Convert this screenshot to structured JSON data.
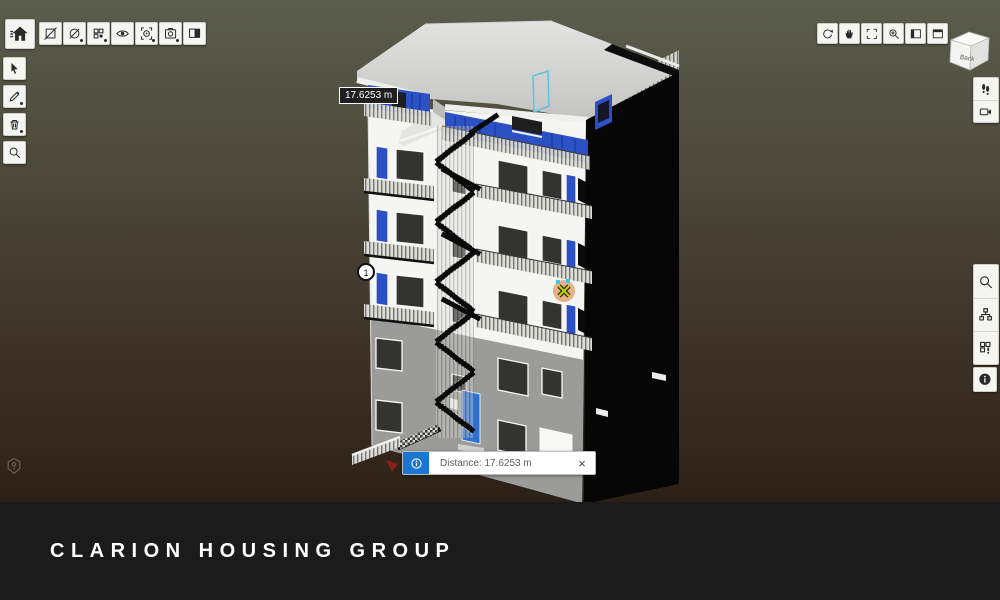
{
  "footer": {
    "brand": "CLARION HOUSING GROUP",
    "background": "#1b1b1b"
  },
  "viewer": {
    "background_top": "#5b5d4c",
    "background_bottom": "#2a2015",
    "measurement": {
      "leader_tag": "17.6253 m",
      "point1_label": "1"
    },
    "notification": {
      "message": "Distance: 17.6253 m",
      "close": "×",
      "accent_color": "#1976d2"
    },
    "view_cube": {
      "front_label": "Back"
    },
    "model_colors": {
      "facade_white": "#f5f5f3",
      "facade_gray": "#9b9b99",
      "roof_gray": "#d6d6d4",
      "side_black": "#060606",
      "panel_blue": "#2b51c4",
      "door_blue": "#2e6fd0",
      "selection_outline": "#5ec1e8",
      "measure_point_fill": "#e2955f",
      "measure_x": "#c8d400"
    }
  },
  "toolbars": {
    "top_left": {
      "home": "home",
      "items": [
        "section-plane",
        "hide-elements",
        "components",
        "visibility",
        "zoom-selection",
        "snapshot",
        "saved-views"
      ]
    },
    "left": {
      "items": [
        "select",
        "markup-pencil",
        "clear-markup",
        "zoom-search"
      ]
    },
    "top_right": {
      "items": [
        "orbit",
        "pan",
        "fit-to-view",
        "zoom-window",
        "panel-side",
        "panel-top"
      ]
    },
    "under_cube": {
      "items": [
        "walk-mode",
        "camera"
      ]
    },
    "right": {
      "items": [
        "search",
        "model-tree",
        "properties"
      ],
      "info_item": "info"
    }
  }
}
